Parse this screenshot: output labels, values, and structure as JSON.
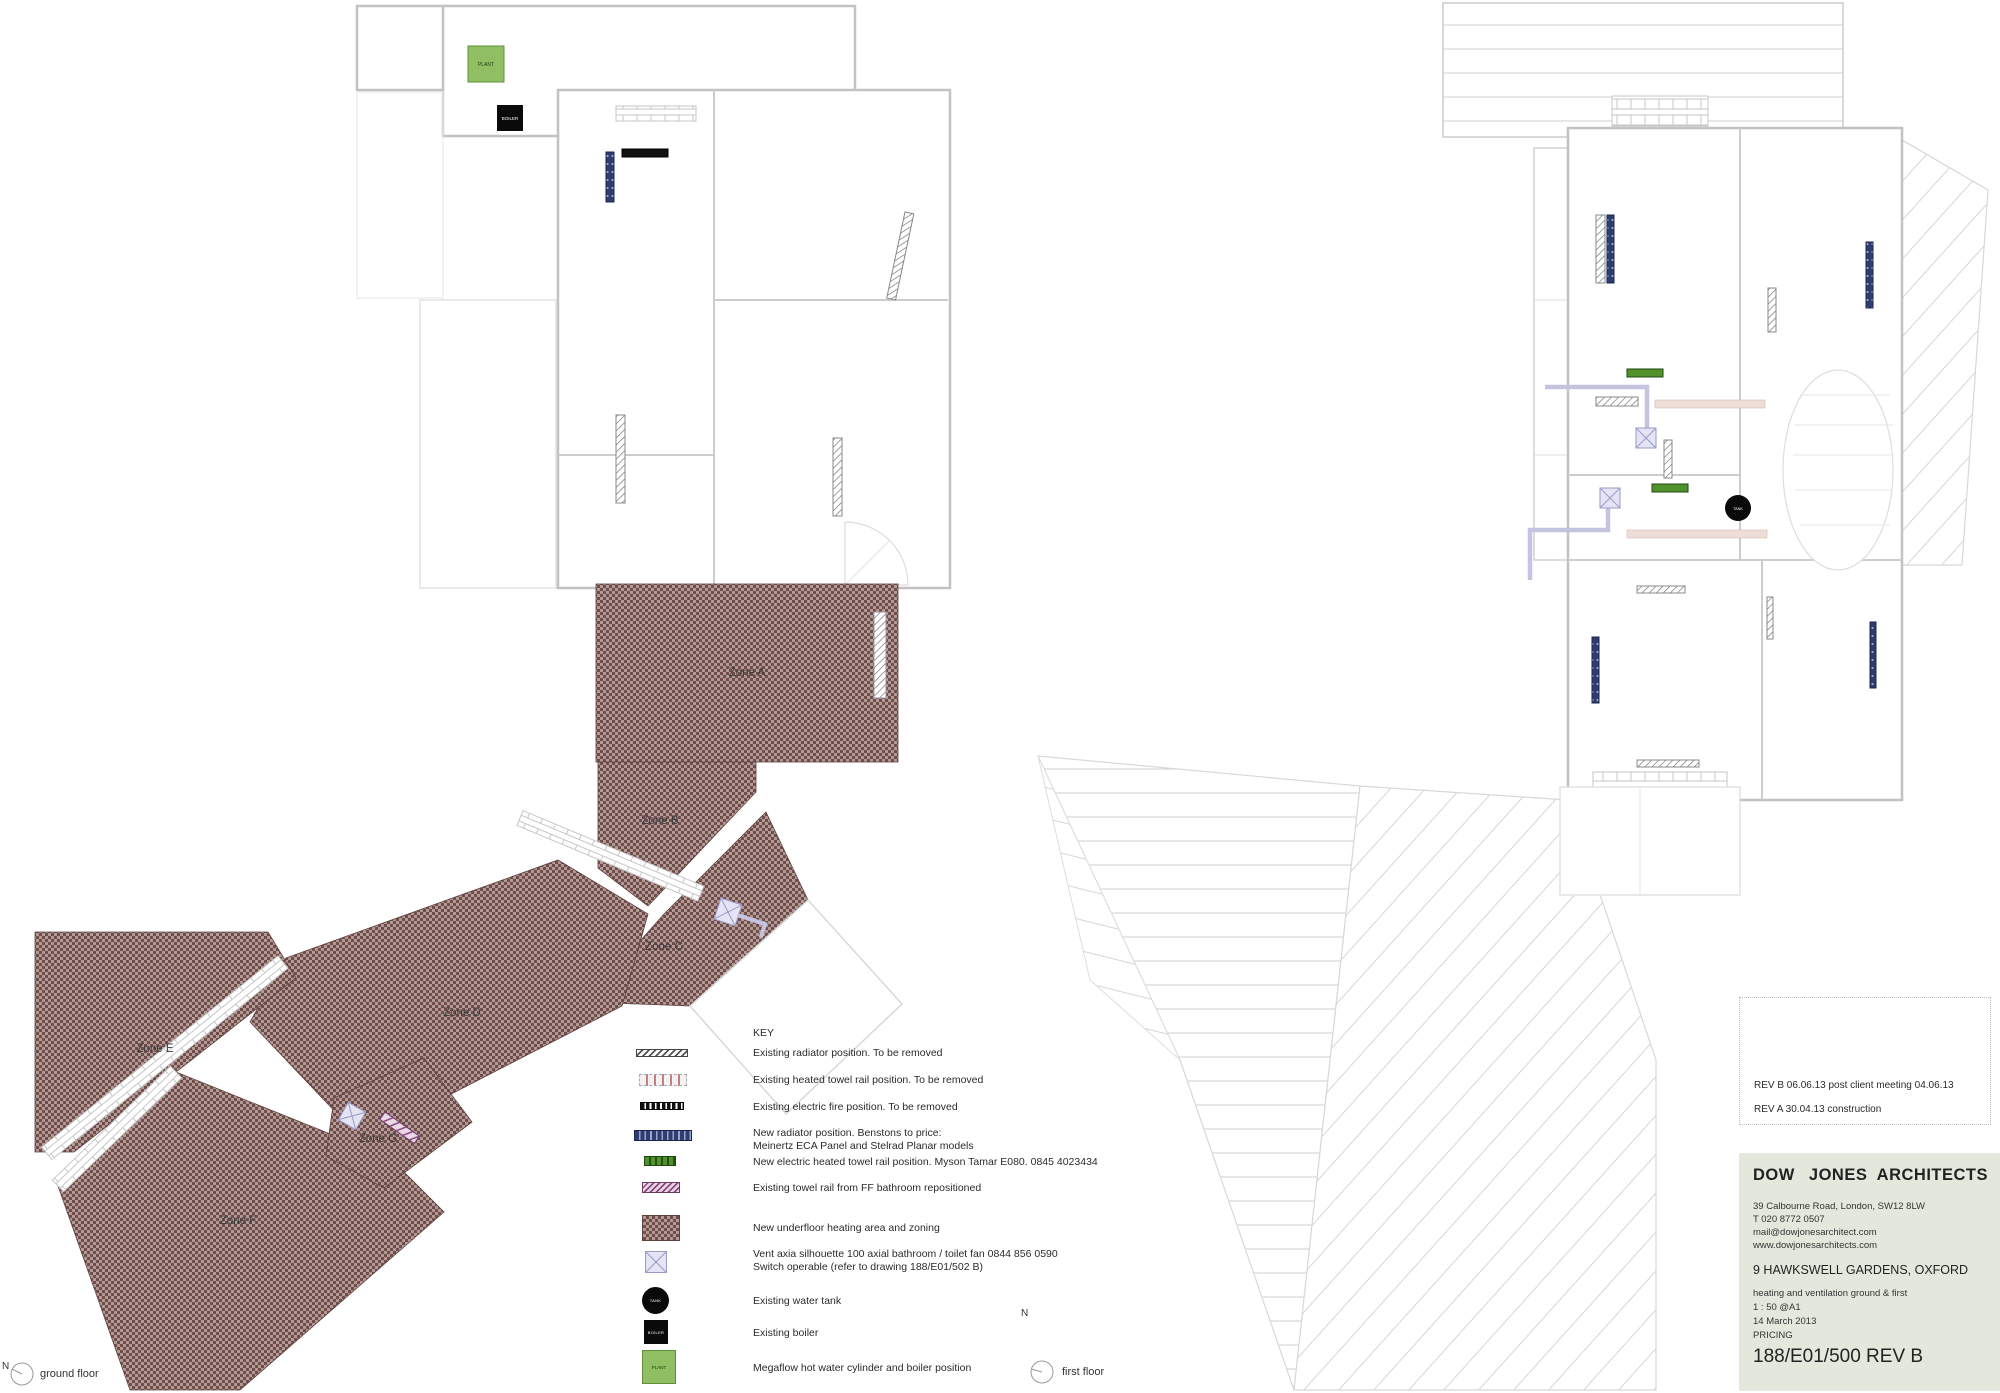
{
  "key": {
    "title": "KEY",
    "items": [
      {
        "symbol": "existing-radiator-symbol",
        "line1": "Existing radiator position. To be removed",
        "line2": ""
      },
      {
        "symbol": "existing-towel-rail-symbol",
        "line1": "Existing heated towel rail position. To be removed",
        "line2": ""
      },
      {
        "symbol": "existing-electric-fire-symbol",
        "line1": "Existing electric fire position. To be removed",
        "line2": ""
      },
      {
        "symbol": "new-radiator-symbol",
        "line1": "New radiator position. Benstons to price:",
        "line2": "Meinertz ECA Panel and Stelrad Planar models"
      },
      {
        "symbol": "new-electric-towel-rail-symbol",
        "line1": "New electric heated towel rail position. Myson Tamar E080. 0845 4023434",
        "line2": ""
      },
      {
        "symbol": "repositioned-towel-rail-symbol",
        "line1": "Existing towel rail from FF bathroom repositioned",
        "line2": ""
      },
      {
        "symbol": "underfloor-heating-symbol",
        "line1": "New underfloor heating area and zoning",
        "line2": ""
      },
      {
        "symbol": "vent-fan-symbol",
        "line1": "Vent axia silhouette 100 axial bathroom / toilet fan 0844 856 0590",
        "line2": "Switch operable (refer to drawing 188/E01/502 B)"
      },
      {
        "symbol": "water-tank-symbol",
        "line1": "Existing water tank",
        "line2": ""
      },
      {
        "symbol": "boiler-symbol",
        "line1": "Existing boiler",
        "line2": ""
      },
      {
        "symbol": "megaflow-symbol",
        "line1": "Megaflow hot water cylinder and boiler position",
        "line2": ""
      }
    ]
  },
  "zones": {
    "labels": [
      "Zone A",
      "Zone B",
      "Zone C",
      "Zone D",
      "Zone E",
      "Zone F",
      "Zone G"
    ]
  },
  "equipment": {
    "plant": "PLANT",
    "boiler": "BOILER",
    "tank": "TANK"
  },
  "floors": {
    "ground": "ground floor",
    "first": "first floor",
    "north_letter": "N"
  },
  "title_block": {
    "revisions": [
      "REV B 06.06.13 post client meeting 04.06.13",
      "REV A 30.04.13 construction"
    ],
    "firm_name_left": "DOW JONES",
    "firm_name_right": "ARCHITECTS",
    "address_lines": [
      "39 Calbourne Road, London, SW12 8LW",
      "T 020 8772 0507",
      "mail@dowjonesarchitect.com",
      "www.dowjonesarchitects.com"
    ],
    "project": "9 HAWKSWELL GARDENS, OXFORD",
    "detail_lines": [
      "heating and ventilation ground & first",
      "1 : 50 @A1",
      "14 March 2013",
      "PRICING"
    ],
    "drawing_number": "188/E01/500 REV B"
  },
  "colors": {
    "underfloor_dark": "#6f4d4a",
    "underfloor_light": "#b39a96",
    "new_radiator_navy": "#2e3c6e",
    "towel_rail_green": "#53912c",
    "plant_green": "#8fbf62",
    "fan_lavender": "#e4e4f4",
    "title_panel_green": "#e2e9dc"
  }
}
